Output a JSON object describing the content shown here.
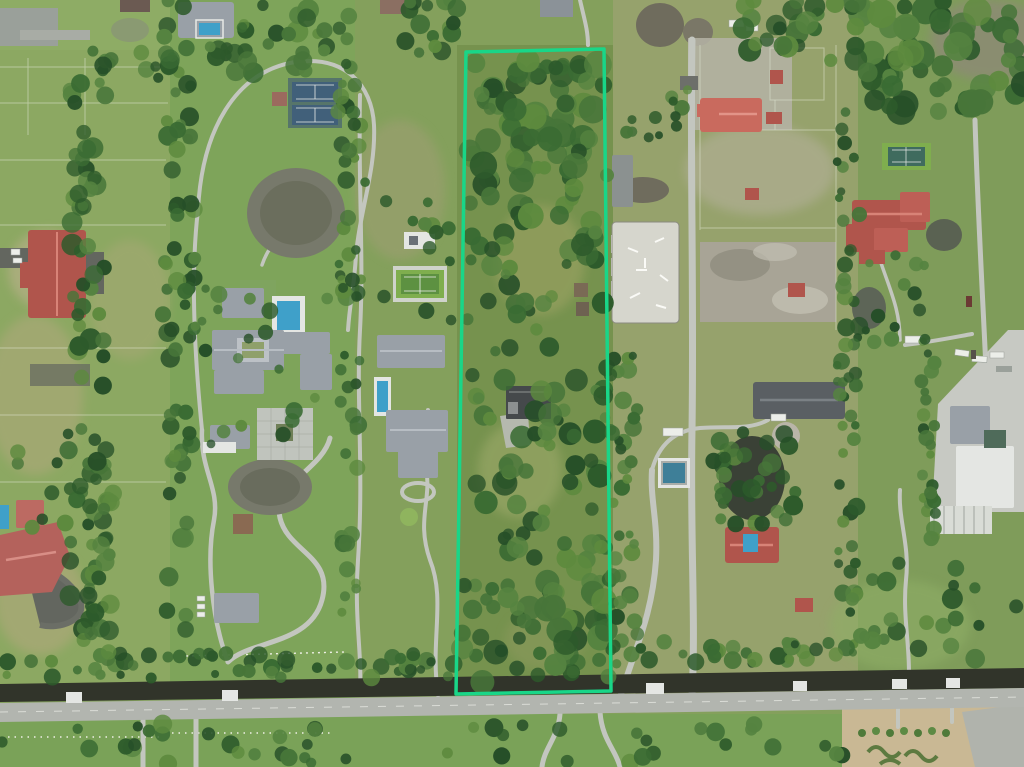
{
  "scene": {
    "kind": "aerial-drone-photograph",
    "boundary_highlight": {
      "color": "#19d688",
      "stroke_width": 3.5,
      "points": "466,52 604,49 611,691 456,694"
    },
    "colors": {
      "grass_base": "#84a05c",
      "grass_light": "#93ae67",
      "grass_estate": "#7aa659",
      "grass_dry": "#b1a97d",
      "forest": [
        "#2d5a2b",
        "#3a6b33",
        "#477539",
        "#558340",
        "#264f28",
        "#5d8a3e"
      ],
      "pond_gray": "#77796b",
      "pond_dark": "#3a4136",
      "pool_blue": "#3fa0c9",
      "roof_red": "#b0554c",
      "roof_gray": "#99a0a7",
      "roof_dark": "#45494b",
      "roof_white": "#e4e6e3",
      "path_gray": "#c3c6bf",
      "road_gray": "#b2b5af",
      "asphalt_dark": "#63665f",
      "canal_dark": "#31342a",
      "sand_arena": "#d6d6cd",
      "dirt_tan": "#a8a496",
      "concrete": "#c7c9c3",
      "garden_tan": "#c9b894",
      "court_green": "#5d9141",
      "court_green_light": "#7fae4e",
      "court_blue": "#41607a",
      "court_teal": "#56756a"
    },
    "features": [
      "highlighted-parcel-boundary",
      "wooded-parcel",
      "parcel-house",
      "parcel-shed",
      "left-stable-barn",
      "left-estate-mansion",
      "double-tennis-court",
      "single-tennis-court",
      "ornamental-pond-north",
      "ornamental-pond-south",
      "estate-pool",
      "lap-pool",
      "paver-courtyard",
      "gazebo",
      "winding-driveway",
      "second-estate-house",
      "equestrian-arena",
      "horse-paddocks",
      "red-barn-cluster",
      "screened-pool",
      "dark-pond",
      "gray-roof-house",
      "red-roof-house-south",
      "red-roof-mansion",
      "right-tennis-court",
      "industrial-yard",
      "warehouses",
      "truck-trailers",
      "perimeter-road",
      "drainage-canal",
      "culvert-bridges",
      "formal-garden",
      "pink-roof-house-southwest",
      "tree-hedgerows"
    ]
  }
}
